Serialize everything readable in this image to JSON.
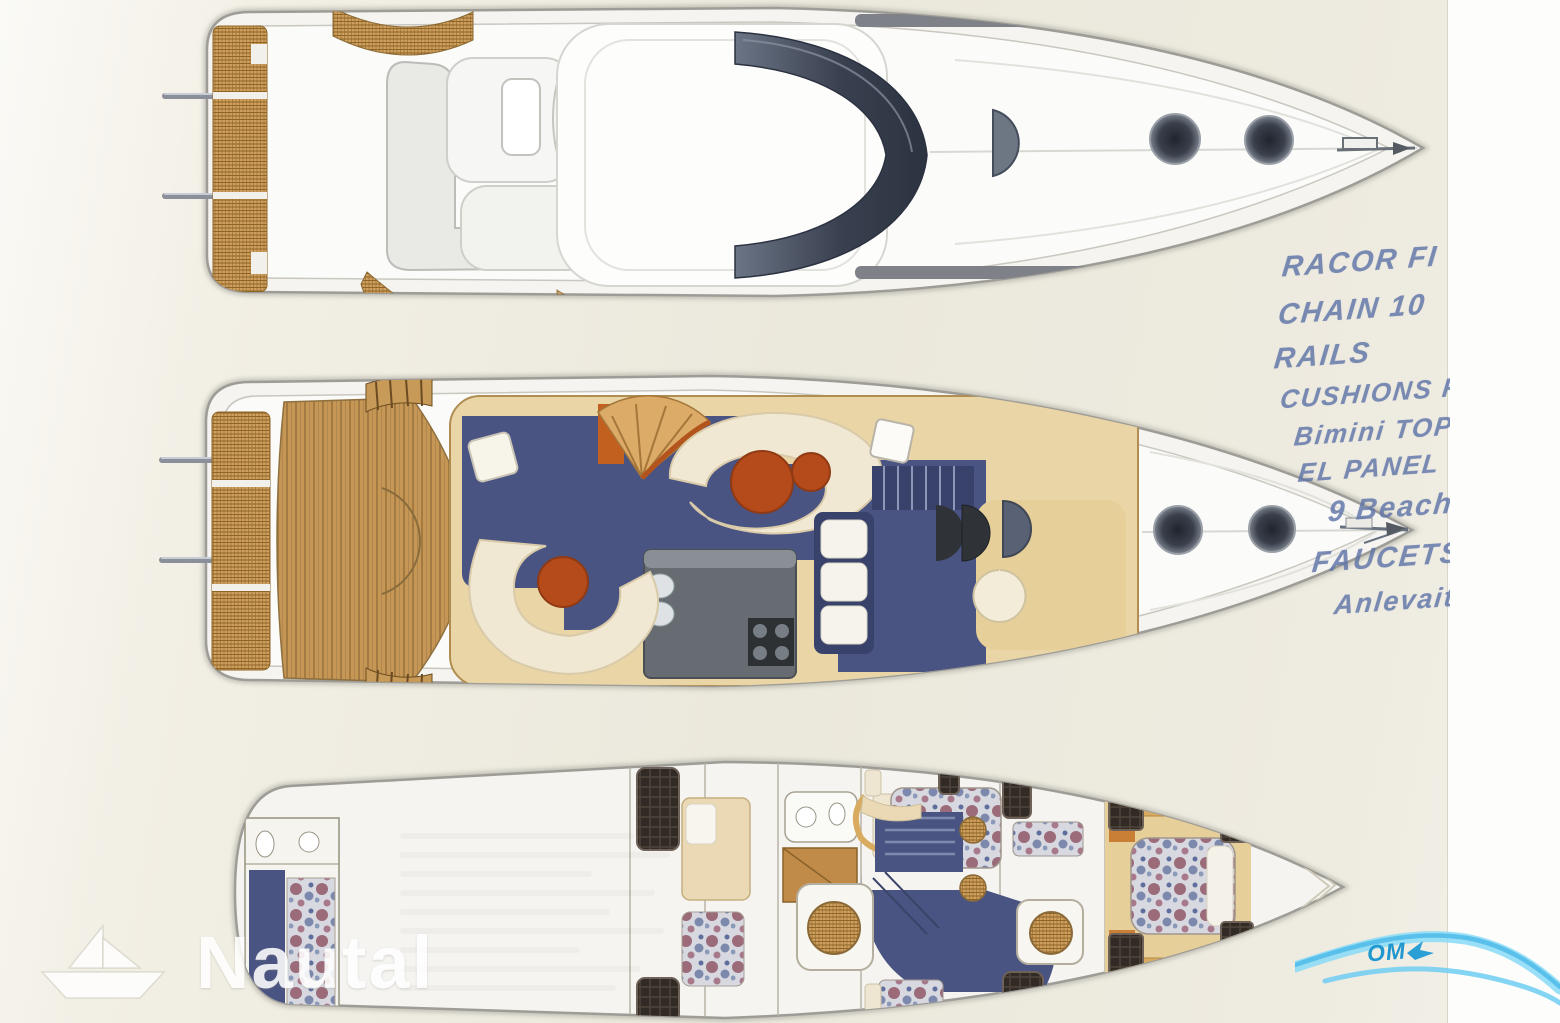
{
  "handwritten_notes": {
    "description": "blue ink handwriting on right margin of scan",
    "lines": [
      {
        "text": "RACOR FI"
      },
      {
        "text": "CHAIN 10"
      },
      {
        "text": "RAILS"
      },
      {
        "text": "CUSHIONS F"
      },
      {
        "text": "Bimini TOP"
      },
      {
        "text": "EL PANEL 7"
      },
      {
        "text": "9 Beach"
      },
      {
        "text": "FAUCETS"
      },
      {
        "text": "Anlevait"
      }
    ]
  },
  "watermarks": {
    "nautal": {
      "brand_text": "Nautal",
      "icon": "paper-boat-icon",
      "color": "#ffffff"
    },
    "corner_logo": {
      "partial_text": "OM",
      "icon": "wave-swoosh-icon",
      "color": "#58c0ea"
    }
  },
  "palette": {
    "page_cream": "#ebe8dc",
    "page_white": "#fdfdfc",
    "hull_white": "#f5f4f1",
    "hull_stroke": "#9d9c96",
    "deck_line": "#c9c7bf",
    "wicker": "#cf9f5e",
    "wicker_dark": "#8d6527",
    "teak": "#c69754",
    "teak_dark": "#97713c",
    "navy": "#4a5482",
    "navy_dark": "#39426b",
    "cream_sofa": "#f1e8d3",
    "salon_tan": "#e9d5a5",
    "galley_gray": "#676c73",
    "orange_table": "#b54a1b",
    "window_dark": "#322a24",
    "gold_floor": "#e7cf9a",
    "wood": "#c08a48",
    "ink_blue": "#5f74a8",
    "watermark_white": "#ffffff",
    "swoosh_blue": "#58c0ea",
    "swoosh_text": "#2097cf"
  }
}
